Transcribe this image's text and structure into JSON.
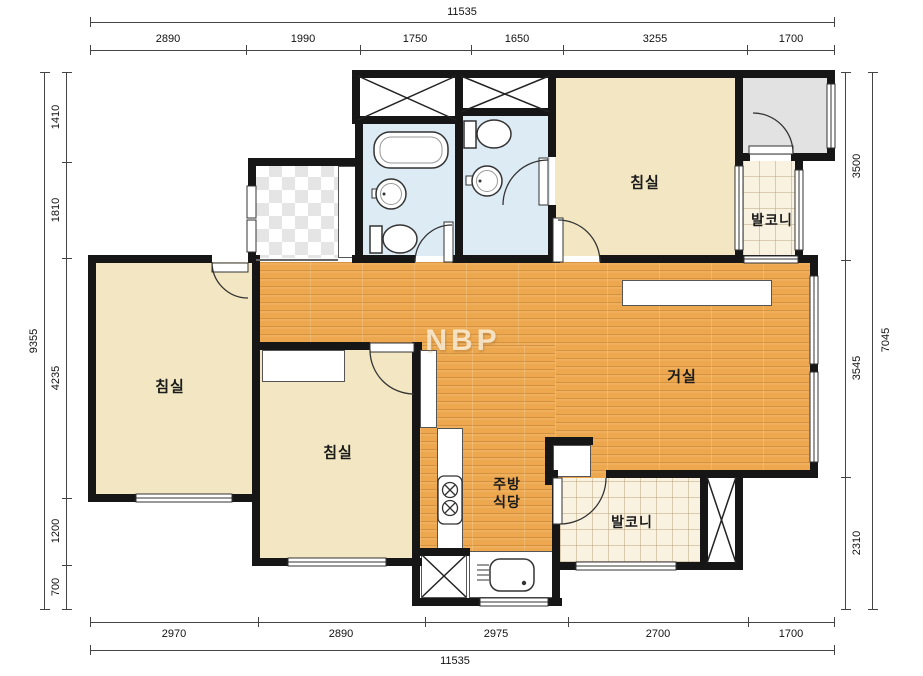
{
  "watermark": "NBP",
  "rooms": {
    "bedroom": "침실",
    "living": "거실",
    "balcony": "발코니",
    "kitchen_line1": "주방",
    "kitchen_line2": "식당"
  },
  "dimensions": {
    "top": {
      "total": "11535",
      "segments": [
        "2890",
        "1990",
        "1750",
        "1650",
        "3255",
        "1700"
      ]
    },
    "bottom": {
      "total": "11535",
      "segments": [
        "2970",
        "2890",
        "2975",
        "2700",
        "1700"
      ]
    },
    "left": {
      "total": "9355",
      "segments": [
        "1410",
        "1810",
        "4235",
        "1200",
        "700"
      ]
    },
    "right": {
      "total": "7045",
      "segments": [
        "3500",
        "3545",
        "2310"
      ]
    }
  },
  "colors": {
    "wall": "#161616",
    "wood_floor": "#eda84f",
    "bedroom_floor": "#f2e7c2",
    "bath_floor": "#dcebf4",
    "balcony_tile": "#f9f2e0",
    "utility_gray": "#e2e2e2"
  }
}
